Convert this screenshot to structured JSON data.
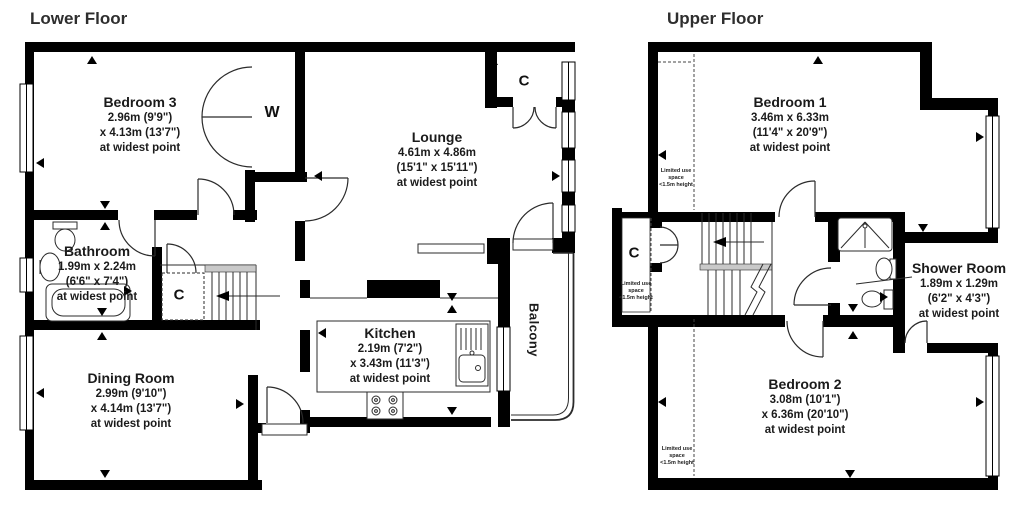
{
  "colors": {
    "wall": "#000000",
    "line": "#2b2b2b",
    "text": "#1b1b1b",
    "grey": "#c9c9c9"
  },
  "lower": {
    "title": "Lower Floor",
    "bedroom3": {
      "name": "Bedroom 3",
      "dim1": "2.96m (9'9\")",
      "dim2": "x 4.13m (13'7\")",
      "note": "at widest point"
    },
    "lounge": {
      "name": "Lounge",
      "dim1": "4.61m x 4.86m",
      "dim2": "(15'1\" x 15'11\")",
      "note": "at widest point"
    },
    "bathroom": {
      "name": "Bathroom",
      "dim1": "1.99m x 2.24m",
      "dim2": "(6'6\" x 7'4\")",
      "note": "at widest point"
    },
    "dining": {
      "name": "Dining Room",
      "dim1": "2.99m (9'10\")",
      "dim2": "x 4.14m (13'7\")",
      "note": "at widest point"
    },
    "kitchen": {
      "name": "Kitchen",
      "dim1": "2.19m (7'2\")",
      "dim2": "x 3.43m (11'3\")",
      "note": "at widest point"
    },
    "balcony": "Balcony",
    "wardrobe": "W",
    "cupboard_lounge": "C",
    "cupboard_stairs": "C"
  },
  "upper": {
    "title": "Upper Floor",
    "bedroom1": {
      "name": "Bedroom 1",
      "dim1": "3.46m x 6.33m",
      "dim2": "(11'4\" x 20'9\")",
      "note": "at widest point"
    },
    "bedroom2": {
      "name": "Bedroom 2",
      "dim1": "3.08m (10'1\")",
      "dim2": "x 6.36m (20'10\")",
      "note": "at widest point"
    },
    "shower": {
      "name": "Shower Room",
      "dim1": "1.89m x 1.29m",
      "dim2": "(6'2\" x 4'3\")",
      "note": "at widest point"
    },
    "cupboard": "C",
    "limited1": "Limited use",
    "limited2": "space",
    "limited3": "<1.5m height"
  }
}
